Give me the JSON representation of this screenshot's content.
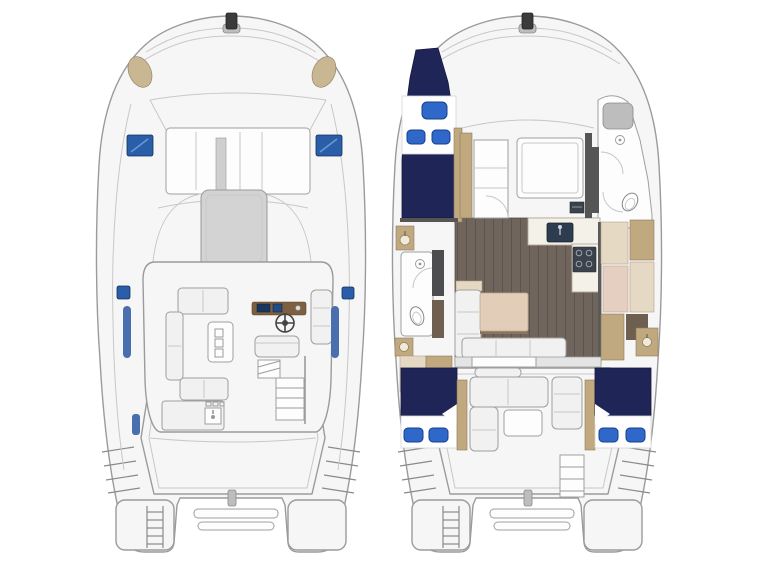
{
  "page": {
    "background": "#ffffff",
    "description_labels_visible": false
  },
  "colors": {
    "hull_fill": "#f6f6f6",
    "hull_stroke": "#9b9b9b",
    "line_soft": "#c8c8c8",
    "sunpad_gray": "#d3d3d3",
    "metal_gray": "#bdbdbd",
    "tan_seat": "#c9b693",
    "hatch_blue": "#2a5ea8",
    "window_blue": "#4a6fae",
    "navy": "#1f2557",
    "pillow_blue": "#2f68c9",
    "pillow_edge": "#17408f",
    "wood_floor": "#6f655c",
    "wood_plank": "#5e544b",
    "beige": "#e6d9c4",
    "tan_wood": "#c0a87f",
    "pink_wood": "#e4cfc0",
    "dark_wood": "#6e5f51",
    "cabinet_dark": "#4d4d4f",
    "appliance_dark": "#3c424c",
    "white_furniture": "#fdfdfd",
    "helm_wood": "#7d5f41",
    "table_wood": "#e2cdb8"
  },
  "plans": [
    {
      "id": "upper-deck",
      "name": "upper-deck-plan",
      "features": [
        "anchor-windlass-icon",
        "bow-corner-seat-icon",
        "deck-hatch-icon",
        "cabin-windshield",
        "coachroof-sunpad",
        "flybridge-settee",
        "flybridge-table",
        "helm-console",
        "steering-wheel-icon",
        "helm-seat",
        "wet-bar-sink-icon",
        "flybridge-stairs",
        "aft-cockpit",
        "swim-platform",
        "boarding-ladder-icon",
        "davit-handle",
        "side-window"
      ]
    },
    {
      "id": "main-deck",
      "name": "accommodation-plan",
      "features": [
        "forward-v-berth",
        "berth-pillow-icon",
        "shower-drain-icon",
        "toilet-icon",
        "vanity-sink-icon",
        "forward-cabin-bed",
        "galley-sink-icon",
        "galley-stove-icon",
        "fridge-cabinet",
        "saloon-wood-floor",
        "dinette-table",
        "dinette-settee",
        "cockpit-lounge",
        "aft-berth-port",
        "aft-berth-starboard",
        "swim-platform",
        "boarding-ladder-icon",
        "davit-handle"
      ]
    }
  ]
}
